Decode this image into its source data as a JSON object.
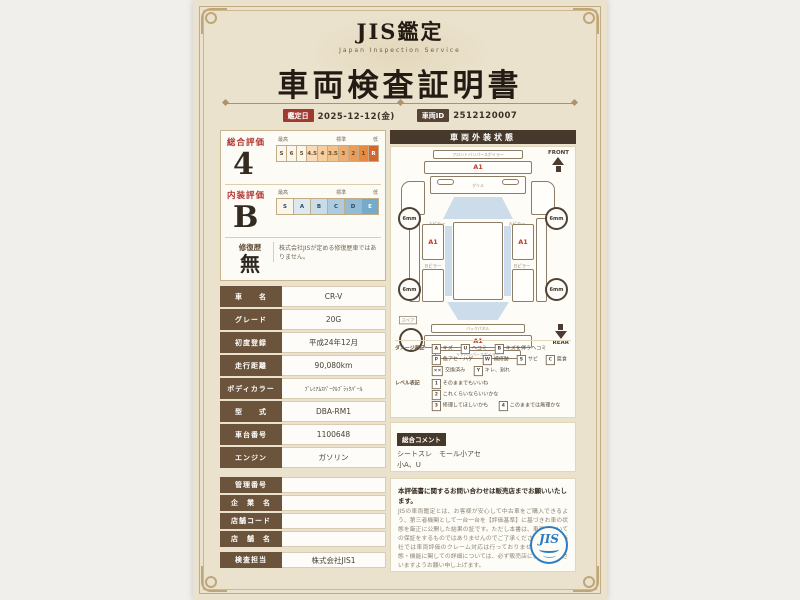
{
  "header": {
    "brand": "JIS鑑定",
    "brand_sub": "Japan Inspection Service",
    "title": "車両検査証明書",
    "date_label": "鑑定日",
    "date_value": "2025-12-12(金)",
    "id_label": "車両ID",
    "id_value": "2512120007"
  },
  "ratings": {
    "overall": {
      "label": "総合評価",
      "value": "4",
      "scale": [
        "S",
        "6",
        "5",
        "4.5",
        "4",
        "3.5",
        "3",
        "2",
        "1",
        "R"
      ],
      "marker_high": "最高",
      "marker_std": "標準",
      "marker_low": "低"
    },
    "interior": {
      "label": "内装評価",
      "value": "B",
      "scale": [
        "S",
        "A",
        "B",
        "C",
        "D",
        "E"
      ],
      "marker_high": "最高",
      "marker_std": "標準",
      "marker_low": "低"
    },
    "repair": {
      "label": "修復歴",
      "value": "無",
      "note": "株式会社JISが定める修復歴車ではありません。"
    }
  },
  "vehicle_table": {
    "rows": [
      {
        "label": "車　　名",
        "value": "CR-V"
      },
      {
        "label": "グレード",
        "value": "20G"
      },
      {
        "label": "初度登録",
        "value": "平成24年12月"
      },
      {
        "label": "走行距離",
        "value": "90,080km"
      },
      {
        "label": "ボディカラー",
        "value": "ﾌﾟﾚﾐｱﾑｽﾊﾟｰｸﾙﾌﾞﾗｯｸﾊﾟｰﾙ"
      },
      {
        "label": "型　　式",
        "value": "DBA-RM1"
      },
      {
        "label": "車台番号",
        "value": "1100648"
      },
      {
        "label": "エンジン",
        "value": "ガソリン"
      }
    ]
  },
  "dealer_table": {
    "rows": [
      {
        "label": "管理番号",
        "value": ""
      },
      {
        "label": "企　業　名",
        "value": ""
      },
      {
        "label": "店舗コード",
        "value": ""
      },
      {
        "label": "店　舗　名",
        "value": ""
      },
      {
        "label": "検査担当",
        "value": "株式会社JIS1"
      }
    ]
  },
  "exterior": {
    "title": "車両外装状態",
    "front_label": "FRONT",
    "rear_label": "REAR",
    "wheel_tread": "6mm",
    "parts": {
      "front_spoiler": "フロントバンパースポイラー",
      "grille": "グリル",
      "a_pillar": "Aピラー",
      "b_pillar": "Bピラー",
      "back_panel": "バックパネル",
      "rear_spoiler": "リアバンパースポイラー",
      "spare": "スペア"
    },
    "damage_marks": [
      {
        "location": "front-bumper",
        "code": "A1"
      },
      {
        "location": "left-front-door",
        "code": "A1"
      },
      {
        "location": "right-front-door",
        "code": "A1"
      },
      {
        "location": "rear-bumper",
        "code": "A1"
      }
    ],
    "legend": {
      "damage_label": "ダメージ表記",
      "damage_items": [
        {
          "code": "A",
          "text": "キズ"
        },
        {
          "code": "U",
          "text": "ヘコミ"
        },
        {
          "code": "B",
          "text": "キズを伴うヘコミ"
        },
        {
          "code": "P",
          "text": "色アセ・ハゲ"
        },
        {
          "code": "W",
          "text": "補修跡"
        },
        {
          "code": "S",
          "text": "サビ"
        },
        {
          "code": "C",
          "text": "腐食"
        },
        {
          "code": "××",
          "text": "交換済み"
        },
        {
          "code": "Y",
          "text": "キレ、割れ"
        }
      ],
      "level_label": "レベル表記",
      "level_items": [
        {
          "code": "1",
          "text": "そのままでもいいね"
        },
        {
          "code": "2",
          "text": "これくらいならいいかな"
        },
        {
          "code": "3",
          "text": "修理してほしいかも"
        },
        {
          "code": "4",
          "text": "このままでは無理かな"
        }
      ]
    }
  },
  "comment": {
    "label": "総合コメント",
    "line1": "シートスレ　モール小アセ",
    "line2": "小A、U"
  },
  "footer": {
    "notice_title": "本評価書に関するお問い合わせは販売店までお願いいたします。",
    "notice_body": "JISの車両鑑定とは、お客様が安心して中古車をご購入できるよう、第三者機関として一台一台を【評価基準】に基づきお車の状態を厳正に公開した結果の証です。ただし本書は、車両についての保証をするものではありませんのでご了承ください。また、当社では車両評価のクレーム対応は行っておりません。車両の状態・機能に関しての詳細については、必ず販売店にご確認くださいますようお願い申し上げます。",
    "logo_text": "JIS"
  }
}
